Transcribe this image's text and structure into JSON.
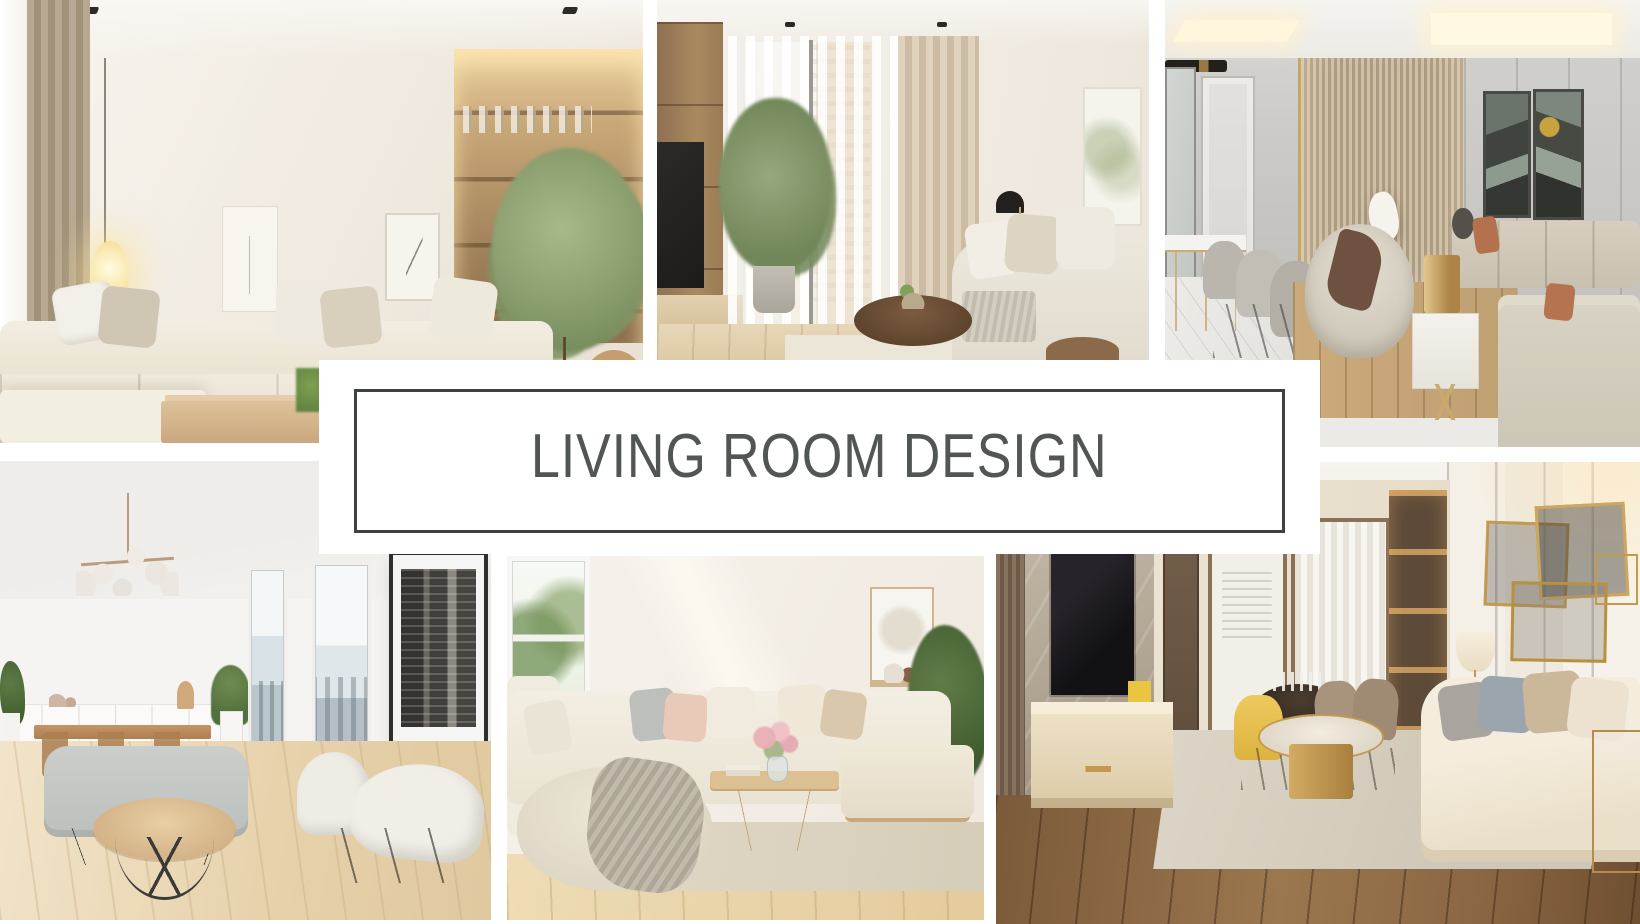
{
  "page": {
    "type": "interior-design-photo-collage",
    "background_color": "#ffffff"
  },
  "banner": {
    "title": "LIVING ROOM DESIGN",
    "text_color": "#515655",
    "border_color": "#3d4140",
    "background_color": "#ffffff"
  },
  "collage": {
    "photos": [
      {
        "id": "top-left",
        "label": "Minimalist beige living room with cream L-shaped modular sofa, glowing oval floor lamp, framed wall art and built-in wooden shelving with a round green indoor tree"
      },
      {
        "id": "top-middle",
        "label": "Bright living room with floor-to-ceiling window, sheer white curtains, potted green tree, wooden TV shelving unit, beige drapes, white sofa with cushions and round dark wood coffee table"
      },
      {
        "id": "top-right",
        "label": "Luxury greige living room with panelled walls, gold-trimmed slat feature wall, white dining table with gray chairs, round cream swivel chairs, brass cylinder lamp on marble side table and beige sectional sofas"
      },
      {
        "id": "bottom-left",
        "label": "Scandinavian open living-dining room with brass globe chandelier, white sideboard, wooden dining set, city-view windows, black and white skyline poster, gray loveseat, round wooden coffee table and two cream armchairs on light wood floor"
      },
      {
        "id": "bottom-middle",
        "label": "Cozy white living room with corner sofa, pastel pink and gray cushions, flower bouquet on wooden coffee table, large pouf with knitted throw blanket, green plant and garden-view window"
      },
      {
        "id": "bottom-right",
        "label": "Modern warm living room with marble TV wall, wooden media console, round gold coffee table on gray rug, dining nook with yellow chair, backlit shelving column, gold geometric wall decor and cream sofa with pillows"
      }
    ]
  }
}
